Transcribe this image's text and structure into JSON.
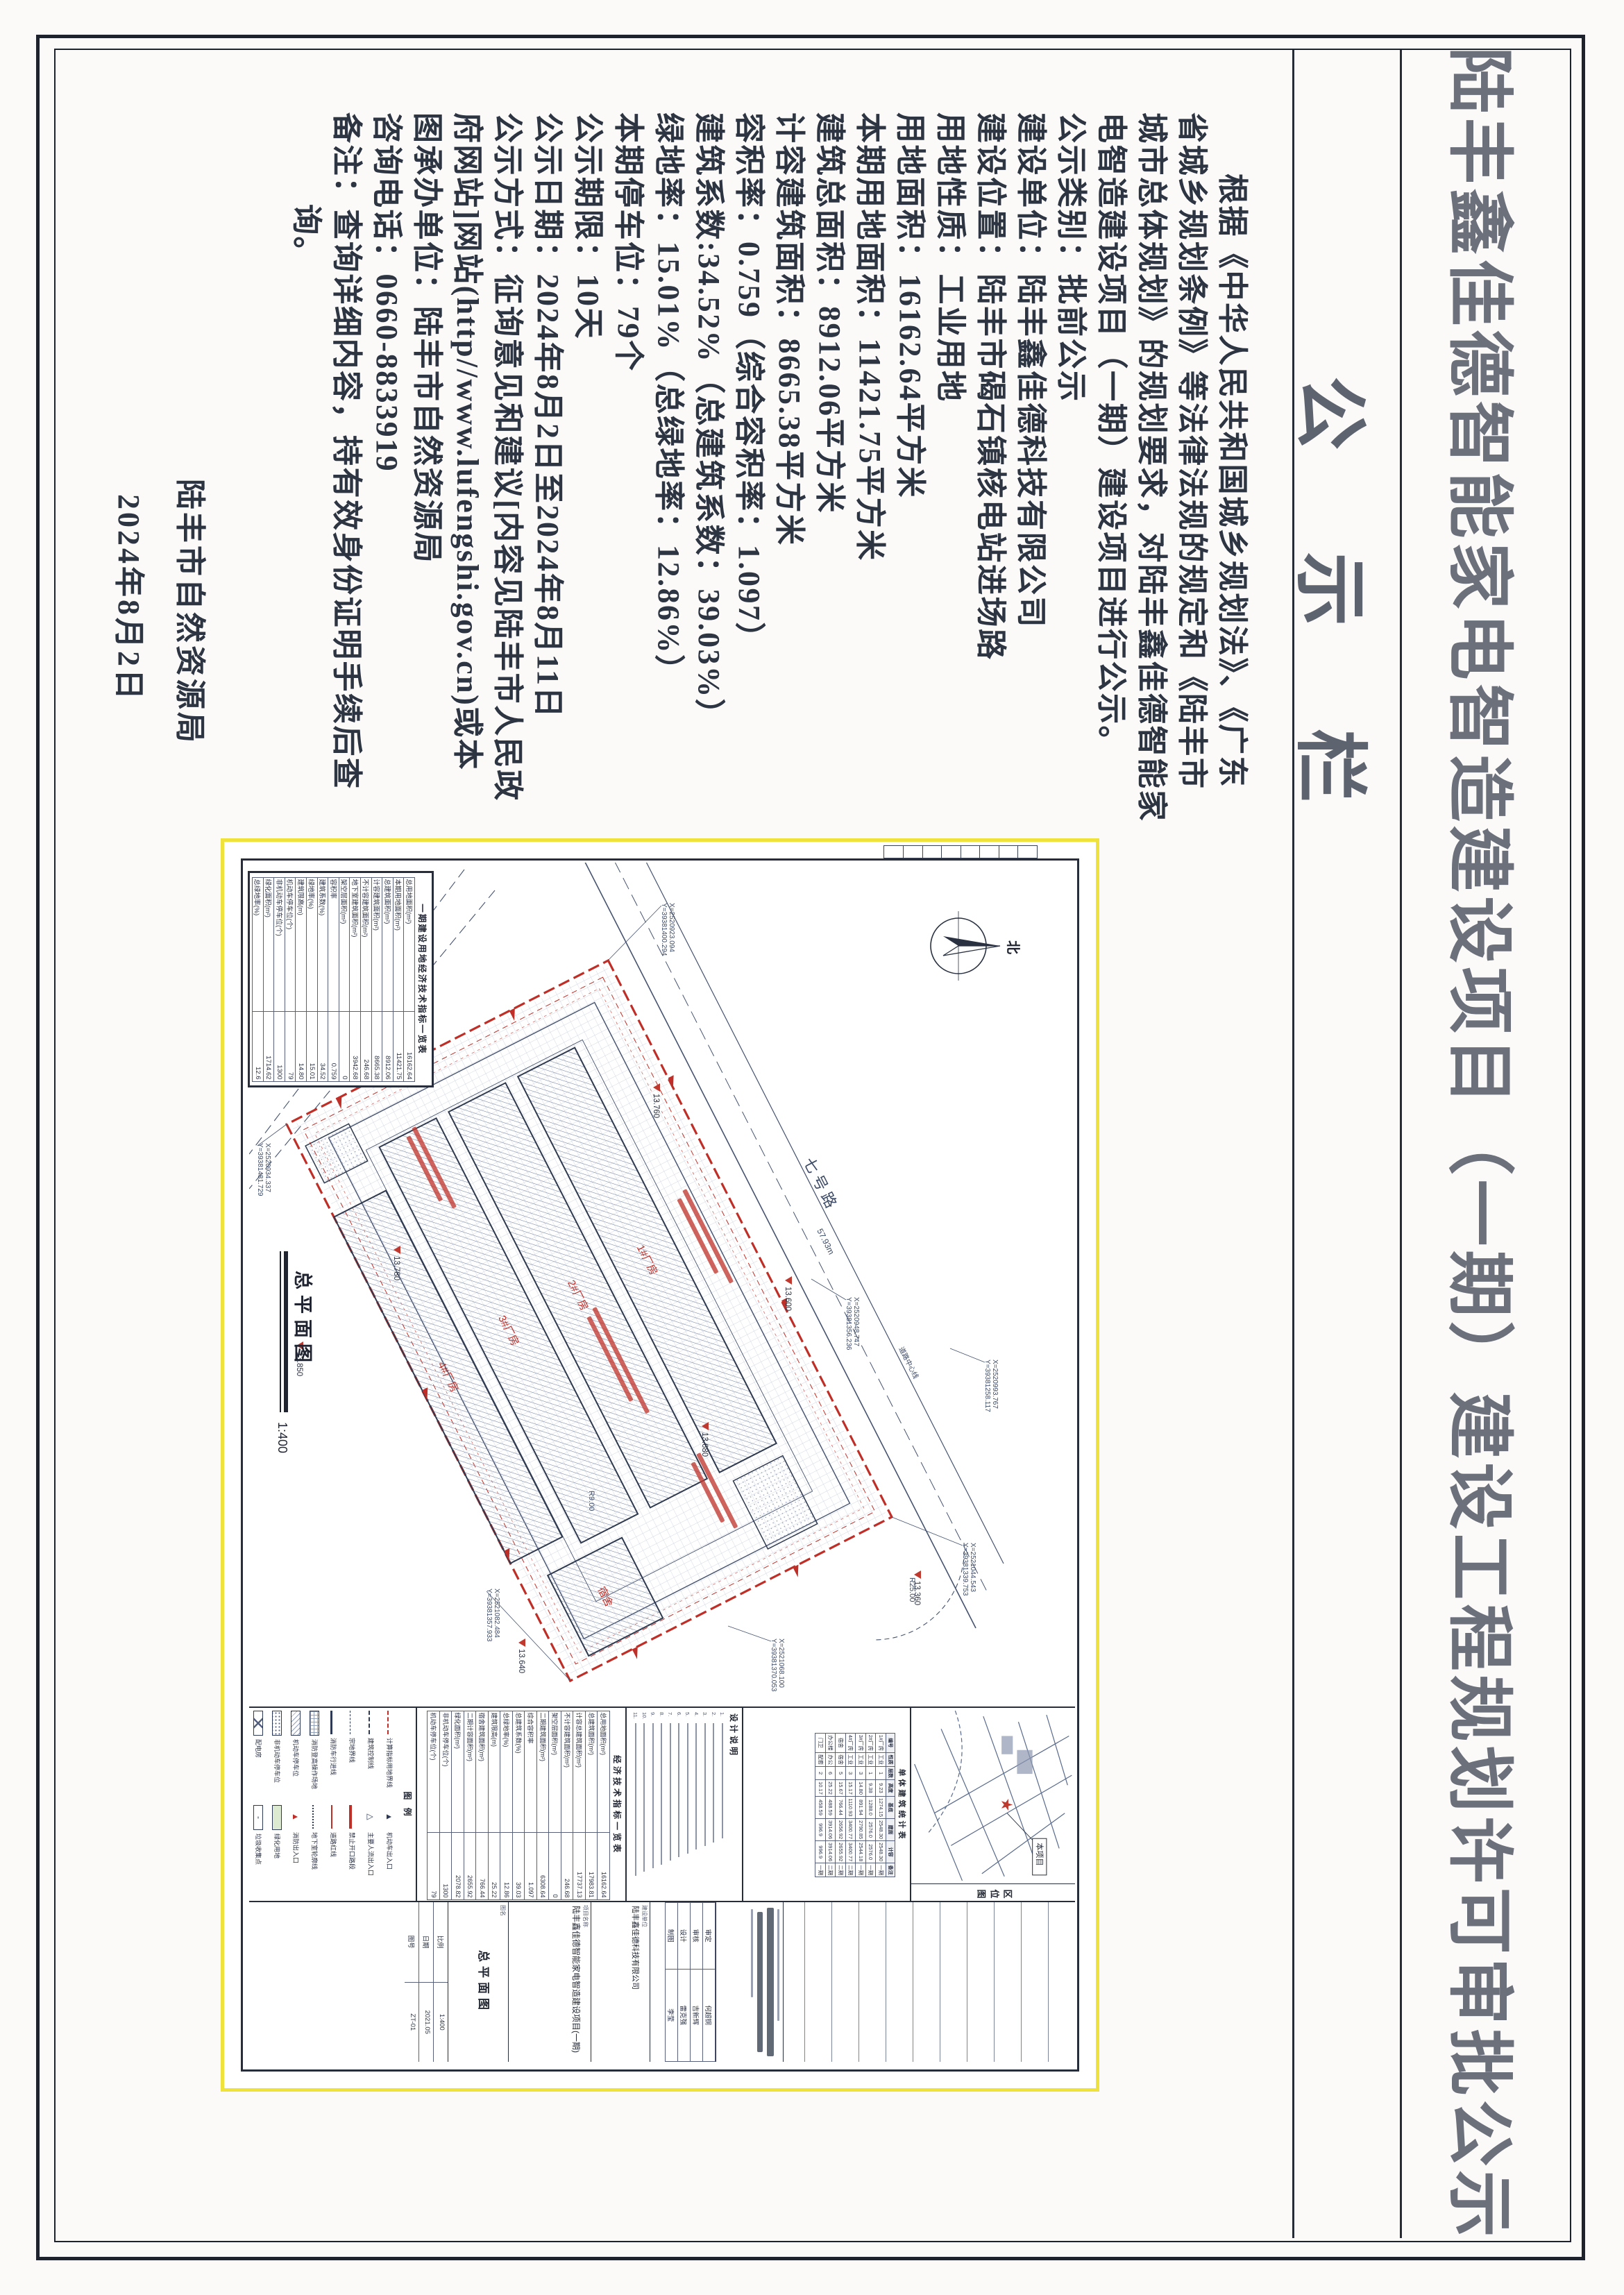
{
  "page": {
    "title": "陆丰鑫佳德智能家电智造建设项目（一期）建设工程规划许可审批公示",
    "board_header": "公示栏"
  },
  "notice": {
    "lines": [
      {
        "t": "根据《中华人民共和国城乡规划法》、《广东",
        "ind": 2
      },
      {
        "t": "省城乡规划条例》等法律法规的规定和《陆丰市",
        "ind": 0
      },
      {
        "t": "城市总体规划》的规划要求，对陆丰鑫佳德智能家",
        "ind": 0
      },
      {
        "t": "电智造建设项目（一期）建设项目进行公示。",
        "ind": 0
      },
      {
        "t": "公示类别：批前公示",
        "ind": 0
      },
      {
        "t": "建设单位：陆丰鑫佳德科技有限公司",
        "ind": 0
      },
      {
        "t": "建设位置：陆丰市碣石镇核电站进场路",
        "ind": 0
      },
      {
        "t": "用地性质：工业用地",
        "ind": 0
      },
      {
        "t": "用地面积：16162.64平方米",
        "ind": 0
      },
      {
        "t": "本期用地面积：11421.75平方米",
        "ind": 0
      },
      {
        "t": "建筑总面积：8912.06平方米",
        "ind": 0
      },
      {
        "t": "计容建筑面积：8665.38平方米",
        "ind": 0
      },
      {
        "t": "容积率：0.759（综合容积率：1.097）",
        "ind": 0
      },
      {
        "t": "建筑系数:34.52%（总建筑系数：39.03%）",
        "ind": 0
      },
      {
        "t": "绿地率：15.01%（总绿地率：12.86%）",
        "ind": 0
      },
      {
        "t": "本期停车位：79个",
        "ind": 0
      },
      {
        "t": "公示期限：10天",
        "ind": 0
      },
      {
        "t": "公示日期：2024年8月2日至2024年8月11日",
        "ind": 0
      },
      {
        "t": "公示方式：征询意见和建议[内容见陆丰市人民政",
        "ind": 0
      },
      {
        "t": "府网站]网站(http//www.lufengshi.gov.cn)或本",
        "ind": 0
      },
      {
        "t": "图承办单位：陆丰市自然资源局",
        "ind": 0
      },
      {
        "t": "咨询电话：0660-8833919",
        "ind": 0
      },
      {
        "t": "备注：查询详细内容，持有效身份证明手续后查",
        "ind": 0
      },
      {
        "t": "询。",
        "ind": 3
      }
    ],
    "signature": "陆丰市自然资源局",
    "date": "2024年8月2日"
  },
  "drawing": {
    "caption": "总平面图",
    "scale": "1:400",
    "north_label": "北",
    "road_name": "七号路",
    "road_length": "57.93m",
    "centerline_label": "道路中心线",
    "radius_a": "R25.00",
    "radius_b": "R9.00",
    "spot_elevations": [
      "13.360",
      "13.600",
      "13.680",
      "13.640",
      "13.760",
      "13.780",
      "13.850",
      "13.950"
    ],
    "coords": [
      [
        "X=2521044.543",
        "Y=39381339.753"
      ],
      [
        "X=2521082.484",
        "Y=39381357.933"
      ],
      [
        "X=2521068.100",
        "Y=39381370.053"
      ],
      [
        "X=2520923.094",
        "Y=39381400.294"
      ],
      [
        "X=2520934.337",
        "Y=39381481.729"
      ],
      [
        "X=2520993.767",
        "Y=39381258.117"
      ],
      [
        "X=2520948.747",
        "Y=39381356.236"
      ],
      [
        "X=2520918.274",
        "Y=39381409.454"
      ]
    ],
    "buildings": [
      {
        "name": "1#厂房"
      },
      {
        "name": "2#厂房"
      },
      {
        "name": "3#厂房"
      },
      {
        "name": "4#厂房"
      },
      {
        "name": "宿舍"
      }
    ],
    "econ_table1": {
      "title": "一期建设用地经济技术指标一览表",
      "rows": [
        [
          "总用地面积(m²)",
          "16162.64"
        ],
        [
          "本期用地面积(m²)",
          "11421.75"
        ],
        [
          "总建筑面积(m²)",
          "8912.06"
        ],
        [
          "计容建筑面积(m²)",
          "8665.38"
        ],
        [
          "不计容建筑面积(m²)",
          "246.68"
        ],
        [
          "地下室建筑面积(m²)",
          "3942.68"
        ],
        [
          "架空层面积(m²)",
          "0"
        ],
        [
          "容积率",
          "0.759"
        ],
        [
          "建筑系数(%)",
          "34.52"
        ],
        [
          "绿地率(%)",
          "15.01"
        ],
        [
          "建筑限高(m)",
          "14.80"
        ],
        [
          "机动车停车位(个)",
          "79"
        ],
        [
          "非机动车停车位(个)",
          "1300"
        ],
        [
          "绿化面积(m²)",
          "1714.62"
        ],
        [
          "总绿地率(%)",
          "12.6"
        ]
      ]
    },
    "stats_table": {
      "title": "单体建筑统计表",
      "headers": [
        "编号",
        "性质",
        "层数",
        "高度",
        "基底",
        "建面",
        "计容",
        "备注"
      ],
      "rows": [
        [
          "1#厂房",
          "工业",
          "1",
          "9.23",
          "1274.15",
          "2548.30",
          "2548.30",
          "一期"
        ],
        [
          "2#厂房",
          "工业",
          "1",
          "9.38",
          "1288.0",
          "2576.0",
          "2576.0",
          "一期"
        ],
        [
          "3#厂房",
          "工业",
          "3",
          "14.80",
          "891.94",
          "2790.85",
          "2544.18",
          "一期"
        ],
        [
          "4#厂房",
          "工业",
          "3",
          "15.17",
          "1110.93",
          "3400.77",
          "3400.77",
          "二期"
        ],
        [
          "宿舍",
          "宿舍",
          "5",
          "15.67",
          "766.44",
          "2656.92",
          "2655.92",
          "二期"
        ],
        [
          "办公楼",
          "办公",
          "6",
          "25.22",
          "488.59",
          "3914.06",
          "3914.06",
          "二期"
        ],
        [
          "门卫",
          "配套",
          "2",
          "10.17",
          "458.59",
          "996.9",
          "996.9",
          "一期"
        ]
      ]
    },
    "econ_table2": {
      "title": "经济技术指标一览表",
      "rows": [
        [
          "总用地面积(m²)",
          "16162.64"
        ],
        [
          "总建筑面积(m²)",
          "17983.81"
        ],
        [
          "计容总建筑面积(m²)",
          "17737.13"
        ],
        [
          "不计容建筑面积(m²)",
          "246.68"
        ],
        [
          "架空层面积(m²)",
          "0"
        ],
        [
          "二期建筑面积(m²)",
          "6308.64"
        ],
        [
          "综合容积率",
          "1.097"
        ],
        [
          "总建筑系数(%)",
          "39.03"
        ],
        [
          "总绿地率(%)",
          "12.86"
        ],
        [
          "建筑限高(m)",
          "25.22"
        ],
        [
          "宿舍建筑面积(m²)",
          "766.44"
        ],
        [
          "二期计容面积(m²)",
          "2655.92"
        ],
        [
          "绿化面积(m²)",
          "2078.82"
        ],
        [
          "非机动车停车位(个)",
          "1300"
        ],
        [
          "机动车停车位(个)",
          "79"
        ]
      ]
    },
    "notes": {
      "title": "设计说明",
      "count": 11
    },
    "legend": {
      "title": "图  例",
      "items": [
        {
          "label": "计算指标用地界线",
          "sym": "line-red-dash"
        },
        {
          "label": "机动车出入口",
          "sym": "tri-solid"
        },
        {
          "label": "建筑控制线",
          "sym": "line-dashdot"
        },
        {
          "label": "主要人流出入口",
          "sym": "tri-open"
        },
        {
          "label": "宗地界线",
          "sym": "line-dash"
        },
        {
          "label": "禁止开口路段",
          "sym": "bar-red"
        },
        {
          "label": "消防车行进线",
          "sym": "line-thick"
        },
        {
          "label": "道路红线",
          "sym": "line-red"
        },
        {
          "label": "消防登高操作场地",
          "sym": "hatch-grid"
        },
        {
          "label": "地下室轮廓线",
          "sym": "line-dot"
        },
        {
          "label": "机动车停车位",
          "sym": "box-grid"
        },
        {
          "label": "消防出入口",
          "sym": "tri-half"
        },
        {
          "label": "非机动车停车位",
          "sym": "box-dots"
        },
        {
          "label": "绿化用地",
          "sym": "box-green"
        },
        {
          "label": "配电房",
          "sym": "box-x"
        },
        {
          "label": "垃圾收集点",
          "sym": "box-dot"
        }
      ]
    },
    "location_map": {
      "title": "区位图",
      "marker": "本项目"
    },
    "titleblock": {
      "client_label": "建设单位",
      "client": "陆丰鑫佳德科技有限公司",
      "project_label": "项目名称",
      "project": "陆丰鑫佳德智能家电智造建设项目(一期)",
      "sheet_label": "图名",
      "sheet_name": "总平面图",
      "roles": [
        [
          "审定",
          "何超铜"
        ],
        [
          "审核",
          "吉新辉"
        ],
        [
          "设计",
          "雷克强"
        ],
        [
          "制图",
          "李莹"
        ]
      ],
      "scale_label": "比例",
      "scale": "1:400",
      "date_label": "日期",
      "date": "2021.05",
      "no_label": "图号",
      "no": "ZT-01"
    }
  },
  "colors": {
    "red": "#bf2f28",
    "yellow_border": "#efe23c",
    "ink": "#46536f",
    "title_gray": "#6b707b"
  }
}
